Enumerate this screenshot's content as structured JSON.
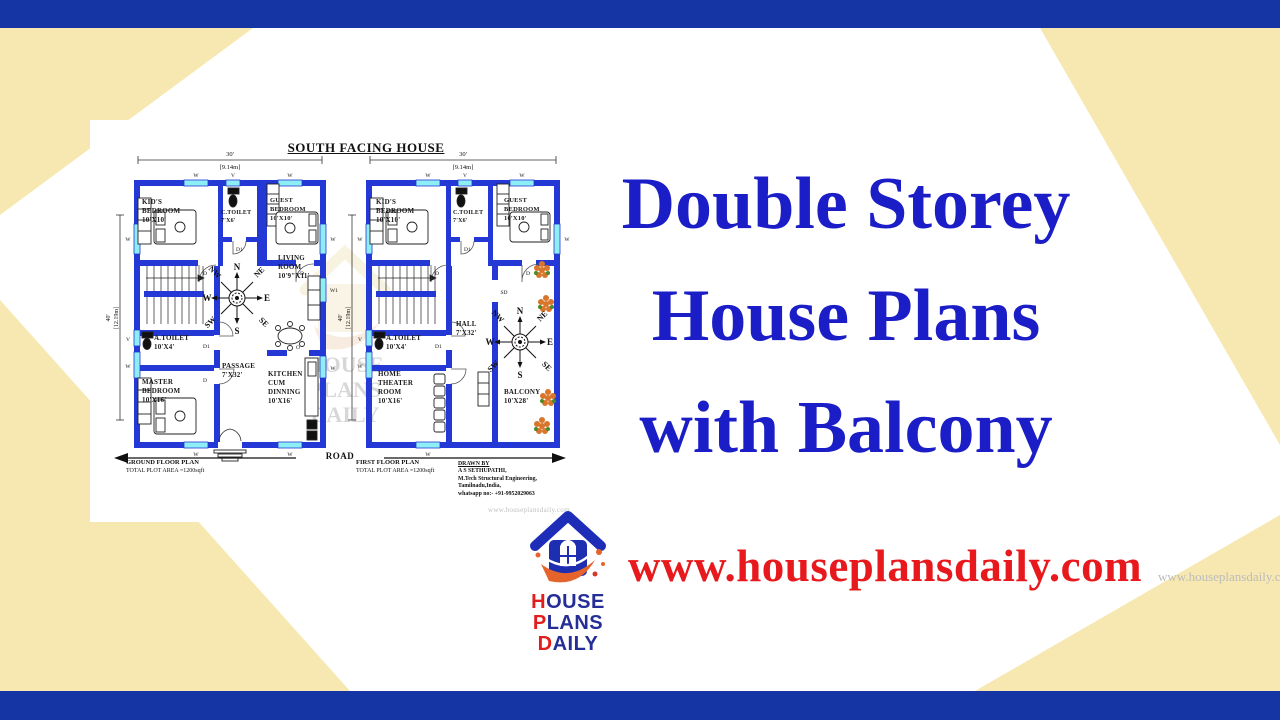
{
  "sheet": {
    "title": "SOUTH FACING HOUSE",
    "road_label": "ROAD",
    "watermark": "www.houseplansdaily.com",
    "center_watermark": {
      "l1": "HOUSE",
      "l2": "PLANS",
      "l3": "DAILY"
    },
    "compass": {
      "n": "N",
      "ne": "NE",
      "e": "E",
      "se": "SE",
      "s": "S",
      "sw": "SW",
      "w": "W",
      "nw": "NW"
    },
    "markers": {
      "window": "W",
      "vent": "V",
      "window1": "W1",
      "door": "D",
      "door1": "D1",
      "opening": "O",
      "sliding": "SD"
    },
    "ground_floor": {
      "dim_w_ft": "30'",
      "dim_w_m": "[9.14m]",
      "dim_h_ft": "40'",
      "dim_h_m": "[12.19m]",
      "rooms": {
        "kids": {
          "name": "KID'S\nBEDROOM",
          "size": "10'X10'"
        },
        "ctoilet": {
          "name": "C.TOILET",
          "size": "7'X6'"
        },
        "guest": {
          "name": "GUEST\nBEDROOM",
          "size": "10'X10'"
        },
        "living": {
          "name": "LIVING\nROOM",
          "size": "10'9\"X11'"
        },
        "atoilet": {
          "name": "A.TOILET",
          "size": "10'X4'"
        },
        "master": {
          "name": "MASTER\nBEDROOM",
          "size": "10'X16'"
        },
        "passage": {
          "name": "PASSAGE",
          "size": "7'X32'"
        },
        "kitchen": {
          "name": "KITCHEN\nCUM\nDINNING",
          "size": "10'X16'"
        }
      },
      "caption": "GROUND FLOOR PLAN",
      "caption_sub": "TOTAL PLOT AREA =1200sqft"
    },
    "first_floor": {
      "dim_w_ft": "30'",
      "dim_w_m": "[9.14m]",
      "dim_h_ft": "40'",
      "dim_h_m": "[12.19m]",
      "rooms": {
        "kids": {
          "name": "KID'S\nBEDROOM",
          "size": "10'X10'"
        },
        "ctoilet": {
          "name": "C.TOILET",
          "size": "7'X6'"
        },
        "guest": {
          "name": "GUEST\nBEDROOM",
          "size": "10'X10'"
        },
        "atoilet": {
          "name": "A.TOILET",
          "size": "10'X4'"
        },
        "hall": {
          "name": "HALL",
          "size": "7'X32'"
        },
        "theater": {
          "name": "HOME\nTHEATER\nROOM",
          "size": "10'X16'"
        },
        "balcony": {
          "name": "BALCONY",
          "size": "10'X28'"
        }
      },
      "caption": "FIRST FLOOR PLAN",
      "caption_sub": "TOTAL PLOT AREA =1200sqft"
    },
    "drawn_by": {
      "heading": "DRAWN BY",
      "line1": "A S SETHUPATHI,",
      "line2": "M.Tech Structural Engineering,",
      "line3": "Tamilnadu,India,",
      "line4": "whatsapp no:- +91-9952029063"
    }
  },
  "headline": {
    "line1": "Double Storey",
    "line2": "House Plans",
    "line3": "with Balcony"
  },
  "footer": {
    "website": "www.houseplansdaily.com",
    "logo": {
      "p1": "H",
      "p2": "OUSE ",
      "p3": "P",
      "p4": "LANS",
      "p5": "D",
      "p6": "AILY"
    }
  },
  "corner_watermark": "www.houseplansdaily.com",
  "colors": {
    "navy_bar": "#1535a5",
    "cream": "#f6e8b0",
    "wall_blue": "#2338d4",
    "window_cyan": "#8eeef5",
    "headline_blue": "#1b1dc7",
    "brand_red": "#e8191d",
    "logo_navy": "#252e96",
    "logo_orange": "#e4642c",
    "compass_purple": "#8a1f63"
  }
}
